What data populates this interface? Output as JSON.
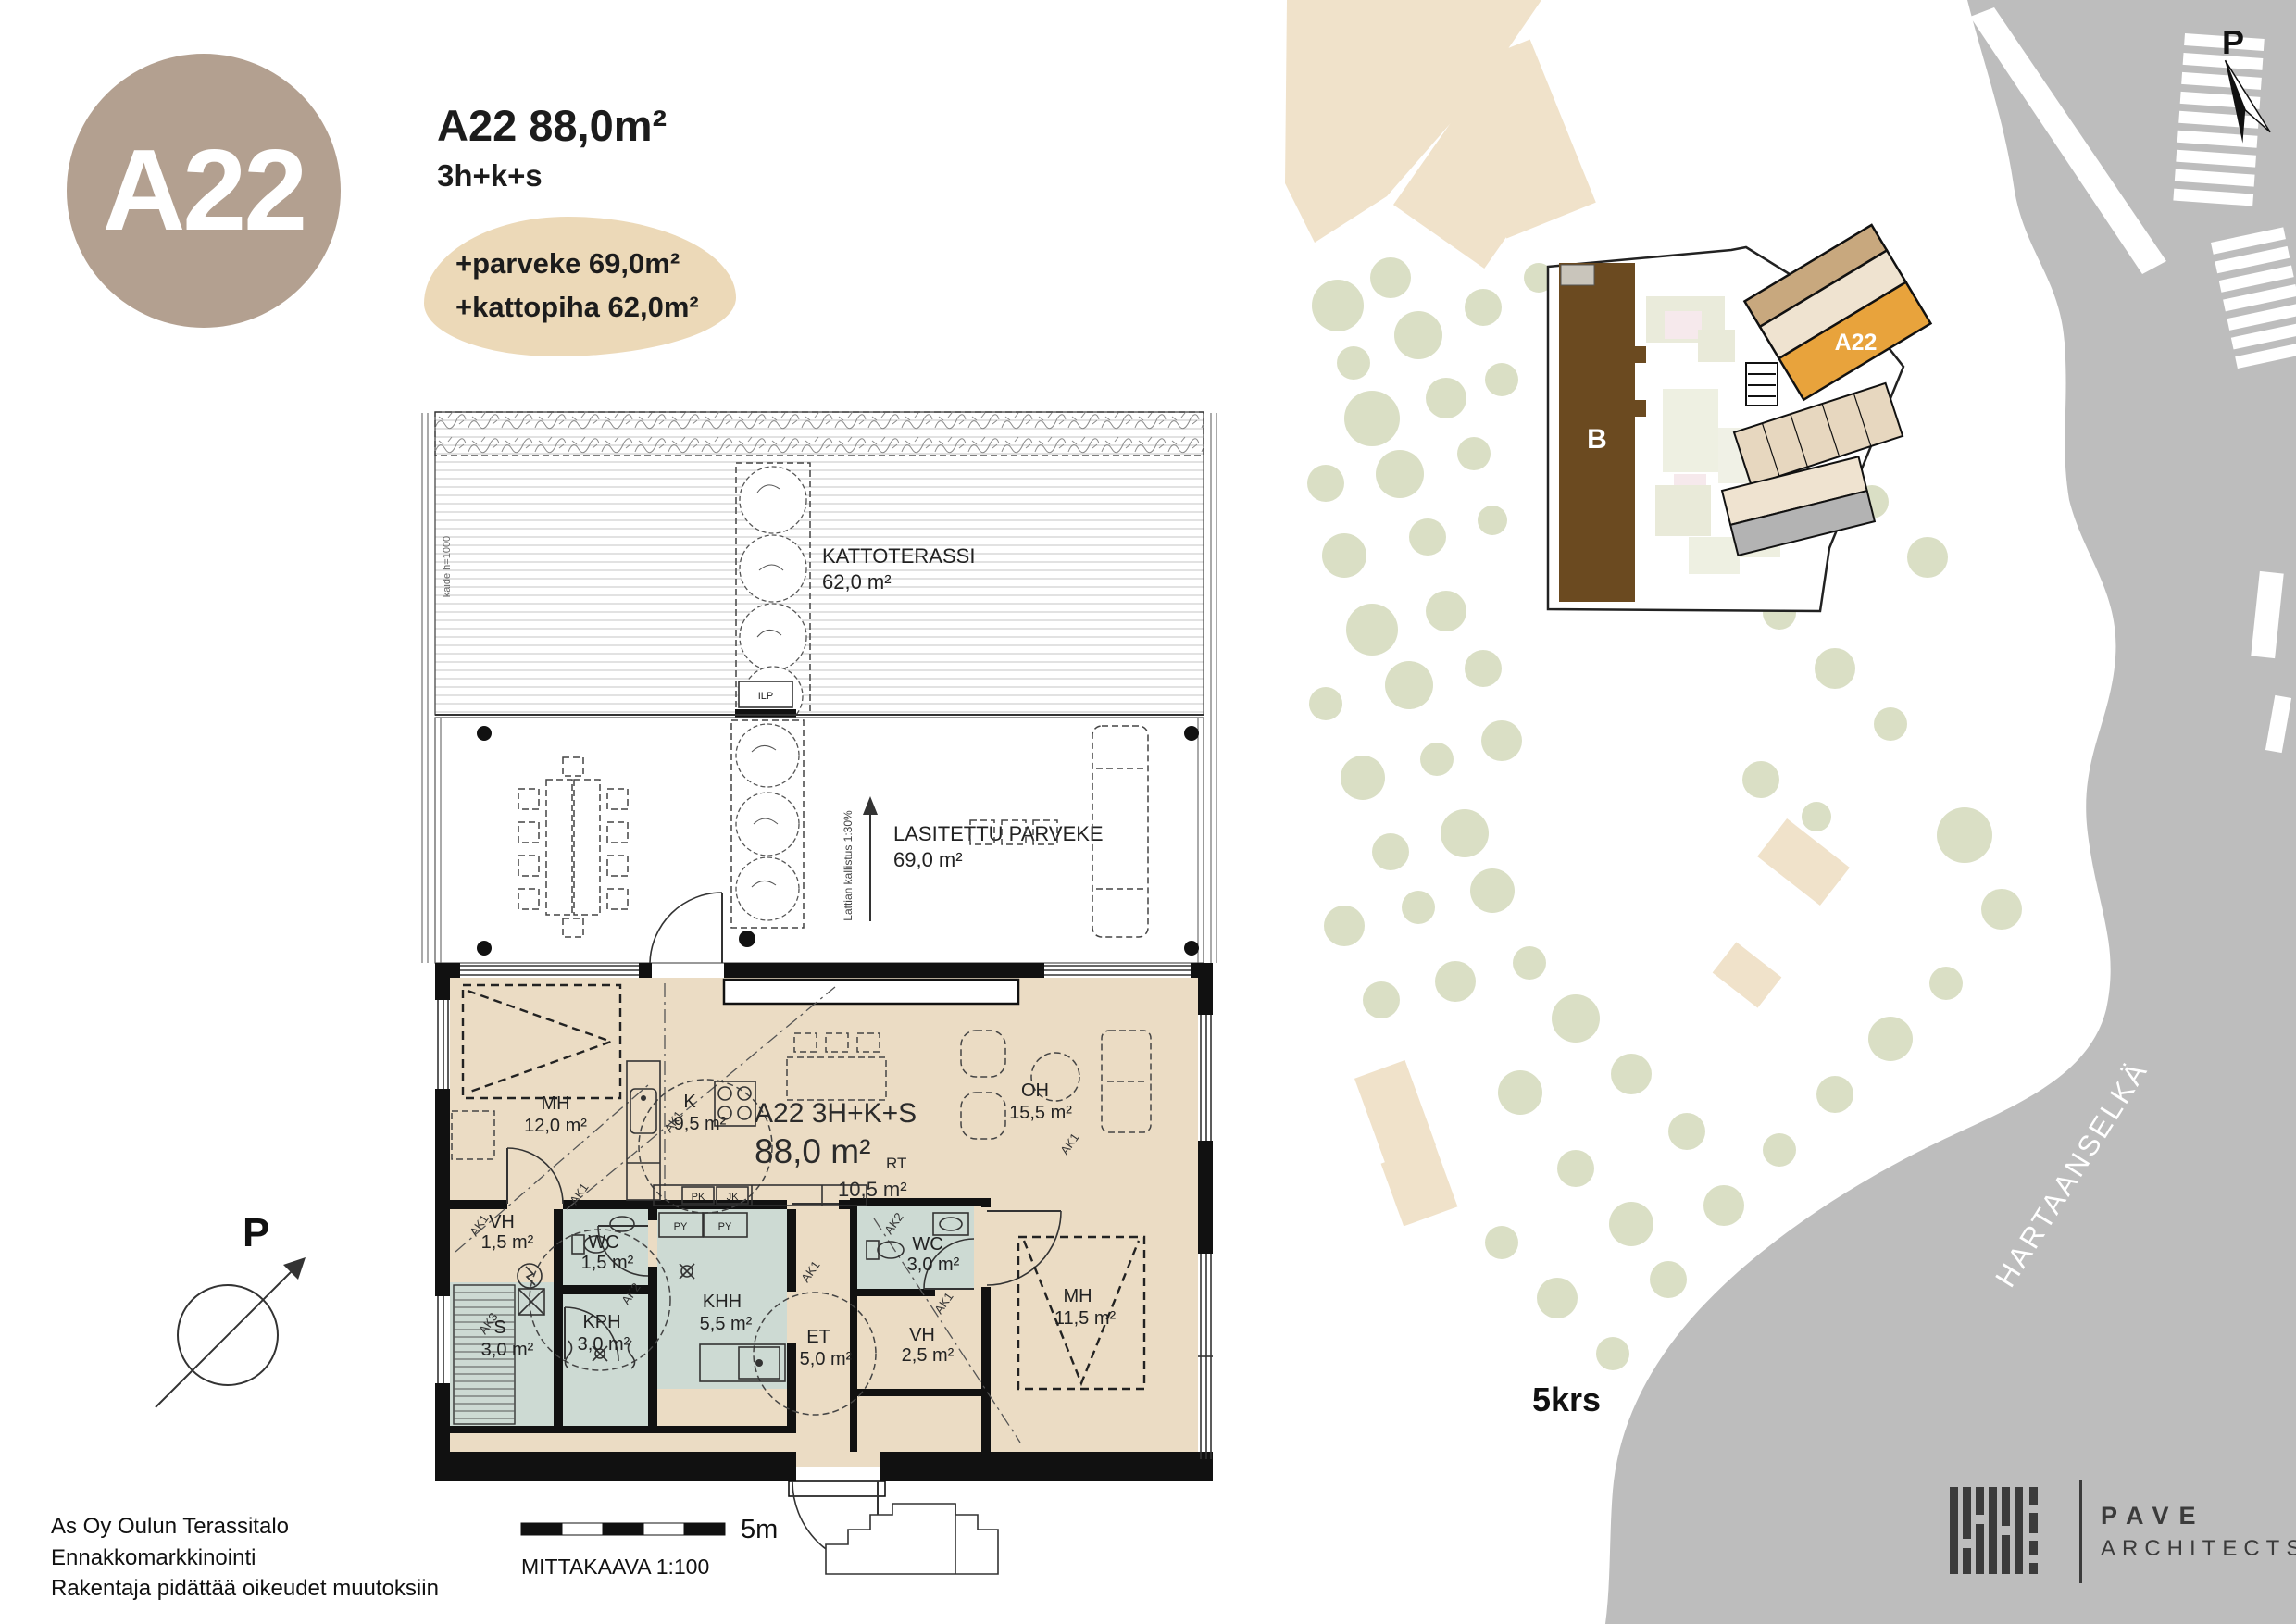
{
  "header": {
    "badge": "A22",
    "title": "A22 88,0m²",
    "subtitle": "3h+k+s",
    "extra1": "+parveke 69,0m²",
    "extra2": "+kattopiha 62,0m²"
  },
  "plan": {
    "kattoterassi": {
      "name": "KATTOTERASSI",
      "area": "62,0 m²"
    },
    "parveke": {
      "name": "LASITETTU PARVEKE",
      "area": "69,0 m²"
    },
    "slope_note": "Lattian kallistus 1:30%",
    "kaide_note": "kaide h=1000",
    "ilp": "ILP",
    "apartment": {
      "id": "A22 3H+K+S",
      "area": "88,0 m²",
      "area_sub": "RT",
      "area2": "10,5 m²"
    },
    "rooms": [
      {
        "name": "MH",
        "area": "12,0 m²"
      },
      {
        "name": "K",
        "area": "9,5 m²"
      },
      {
        "name": "OH",
        "area": "15,5 m²"
      },
      {
        "name": "VH",
        "area": "1,5 m²"
      },
      {
        "name": "WC",
        "area": "1,5 m²"
      },
      {
        "name": "KPH",
        "area": "3,0 m²"
      },
      {
        "name": "KHH",
        "area": "5,5 m²"
      },
      {
        "name": "S",
        "area": "3,0 m²"
      },
      {
        "name": "ET",
        "area": "5,0 m²"
      },
      {
        "name": "WC",
        "area": "3,0 m²"
      },
      {
        "name": "VH",
        "area": "2,5 m²"
      },
      {
        "name": "MH",
        "area": "11,5 m²"
      }
    ],
    "fixture_labels": {
      "pk": "PK",
      "jk": "JK",
      "py": "PY"
    },
    "ak_labels": [
      "AK1",
      "AK2",
      "AK3"
    ],
    "compass": "P"
  },
  "site": {
    "building_b": "B",
    "unit_highlight": "A22",
    "water_label": "HARTAANSELKÄ",
    "floor_label": "5krs",
    "north": "P"
  },
  "footer": {
    "line1": "As Oy Oulun Terassitalo",
    "line2": "Ennakkomarkkinointi",
    "line3": "Rakentaja pidättää oikeudet muutoksiin",
    "scale_value": "5m",
    "scale_text": "MITTAKAAVA 1:100"
  },
  "brand": {
    "name": "PAVE",
    "type": "ARCHITECTS"
  },
  "colors": {
    "badge_tan": "#b3a090",
    "highlight_blob": "#ecd9b8",
    "floor_beige": "#ebdcc4",
    "wet_room_green": "#cddad3",
    "water_gray": "#bdbdbd",
    "tree_green": "#d8ddc2",
    "site_path_beige": "#f0e2ca",
    "unit_a22_orange": "#e8a33c",
    "building_b_brown": "#6b4a20",
    "wall_black": "#111111",
    "logo_gray": "#3b3b3b"
  }
}
